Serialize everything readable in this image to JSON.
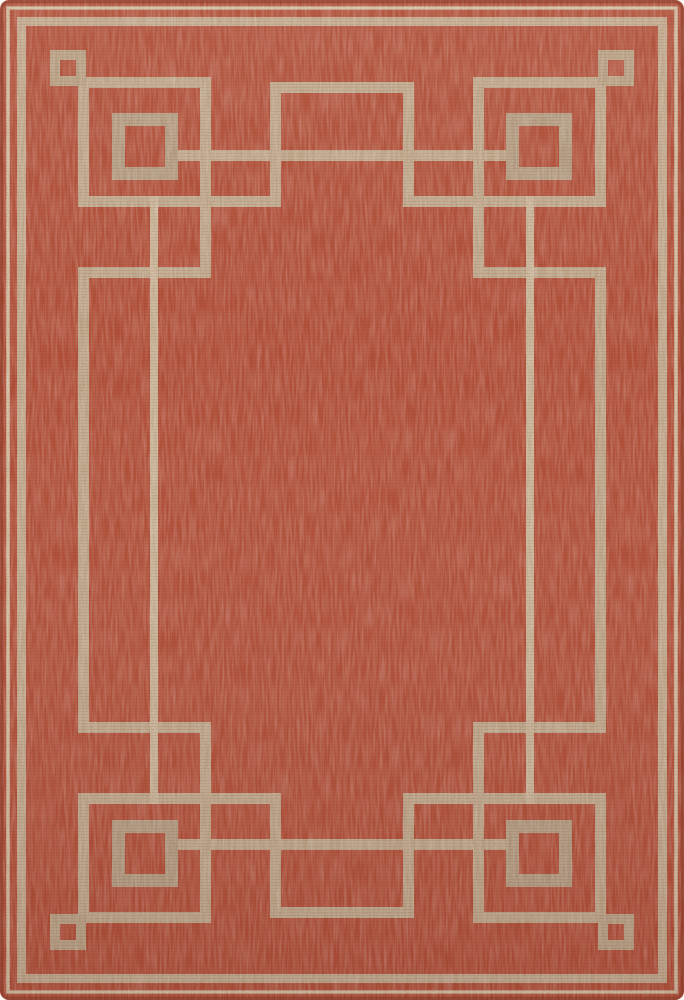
{
  "page": {
    "background": "#faf9f7"
  },
  "rug": {
    "description": "Flat-woven rectangular area rug, rust-red field with tan art-deco Greek-key border: corner squares, interlocking stepped lines, floating squares and center tab motifs",
    "width": 684,
    "height": 1000,
    "corner_radius": 9,
    "colors": {
      "field": "#b5503a",
      "line_thin": "#d7c7aa",
      "line_main": "#c6b296",
      "line_key": "#c2af92",
      "square_small": "#bba88b",
      "square_big": "#b6a388",
      "inner_line": "#cdbda0",
      "edge_shadow": "rgba(122,50,34,0.45)",
      "weft_row": "rgba(112,38,24,0.10)",
      "highlight": "#ffefdc",
      "shadow_tint": "#3c130a"
    },
    "geometry": {
      "thin_border": {
        "inset_center": 8,
        "thickness": 3.5
      },
      "main_border": {
        "inset_center": 21.5,
        "thickness": 9
      },
      "small_square": {
        "x": 50,
        "y": 50,
        "w": 36,
        "h": 36,
        "thickness": 10
      },
      "big_square": {
        "x": 112,
        "y": 113,
        "w": 66,
        "h": 67,
        "thickness": 13
      },
      "key_segments": [
        {
          "name": "top-outer-run",
          "rect": [
            86,
            77,
            125,
            11
          ]
        },
        {
          "name": "corner-step-vertical",
          "rect": [
            200,
            77,
            11,
            201
          ]
        },
        {
          "name": "mid-frame-run",
          "rect": [
            178,
            150,
            328,
            11
          ]
        },
        {
          "name": "tab-side-vertical",
          "rect": [
            270,
            82,
            11,
            125
          ]
        },
        {
          "name": "second-rung",
          "rect": [
            78,
            196,
            203,
            11
          ]
        },
        {
          "name": "third-rung",
          "rect": [
            78,
            267,
            133,
            11
          ]
        },
        {
          "name": "corner-outer-vertical",
          "rect": [
            78,
            86,
            11,
            121
          ]
        },
        {
          "name": "side-long-vertical",
          "rect": [
            78,
            267,
            11,
            466
          ]
        },
        {
          "name": "inner-field-vertical",
          "rect": [
            150,
            196,
            8,
            608
          ],
          "color": "inner_line"
        },
        {
          "name": "tab-cap",
          "rect": [
            270,
            82,
            144,
            11
          ]
        }
      ]
    }
  }
}
